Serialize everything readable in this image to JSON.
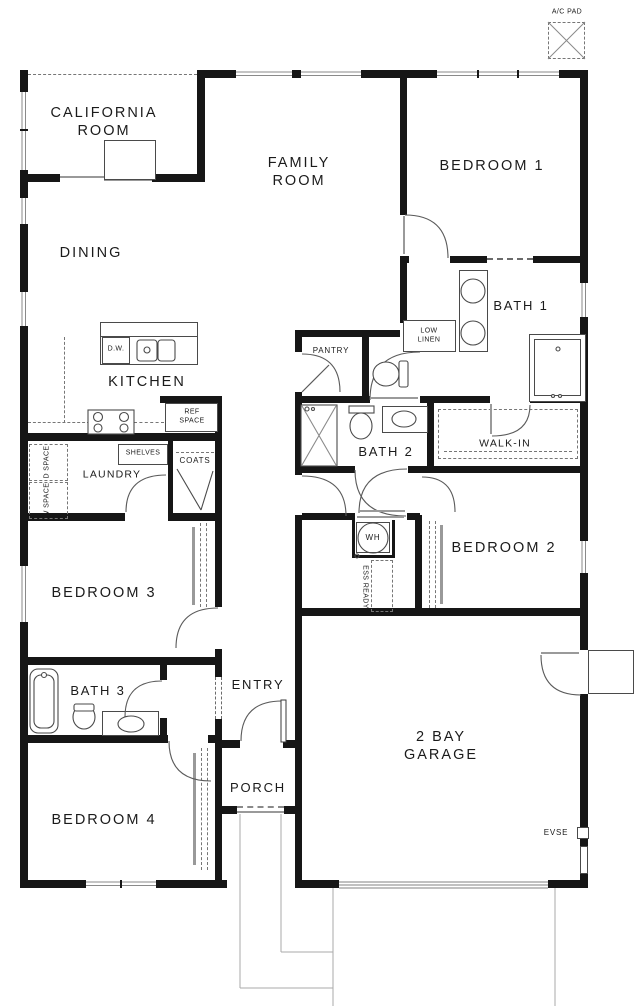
{
  "plan": {
    "type": "single-story residential floor plan",
    "labels": {
      "california_room": "CALIFORNIA\nROOM",
      "family_room": "FAMILY\nROOM",
      "bedroom_1": "BEDROOM 1",
      "dining": "DINING",
      "bath_1": "BATH 1",
      "low_linen": "LOW\nLINEN",
      "pantry": "PANTRY",
      "kitchen": "KITCHEN",
      "dw": "D.W.",
      "ref_space": "REF\nSPACE",
      "bath_2": "BATH 2",
      "walk_in": "WALK-IN",
      "shelves": "SHELVES",
      "coats": "COATS",
      "laundry": "LAUNDRY",
      "d_space": "D SPACE",
      "w_space": "W SPACE",
      "wh": "WH",
      "ess_ready": "ESS READY",
      "bedroom_2": "BEDROOM 2",
      "bedroom_3": "BEDROOM 3",
      "bath_3": "BATH 3",
      "entry": "ENTRY",
      "garage": "2 BAY\nGARAGE",
      "porch": "PORCH",
      "bedroom_4": "BEDROOM 4",
      "ac_pad": "A/C PAD",
      "evse": "EVSE"
    },
    "colors": {
      "wall": "#161616",
      "line": "#4a4a4a",
      "window": "#8a8a8a",
      "dash": "#777777",
      "text": "#1b1b1b",
      "background": "#ffffff"
    }
  }
}
